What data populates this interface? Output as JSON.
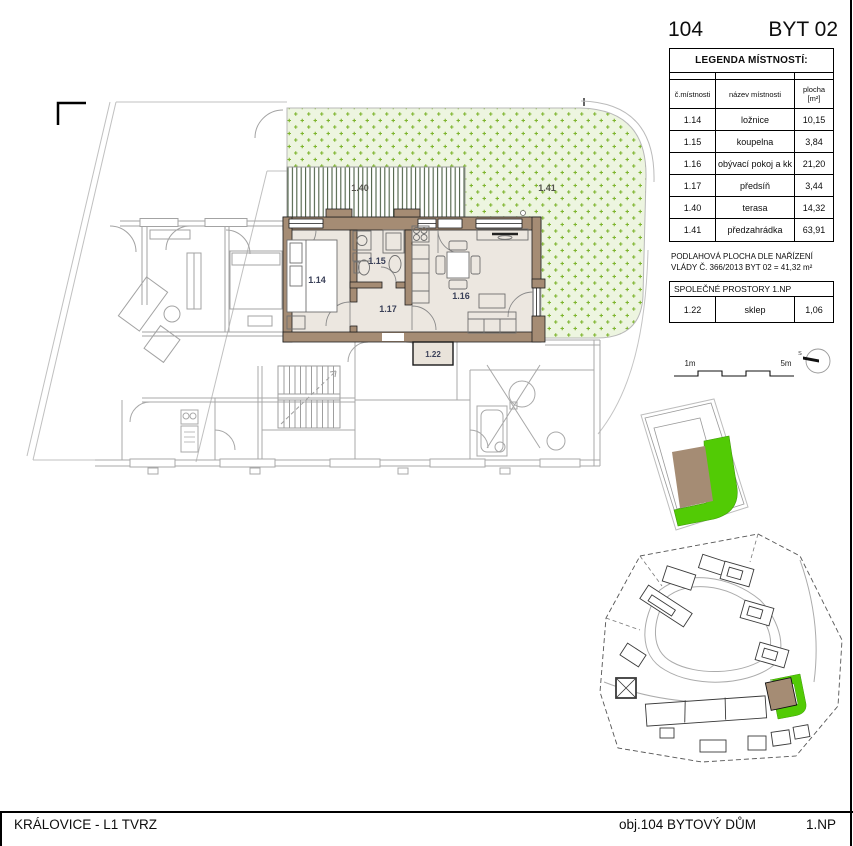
{
  "header": {
    "unit_number": "104",
    "unit_label": "BYT 02"
  },
  "legend": {
    "title": "LEGENDA MÍSTNOSTÍ:",
    "columns": {
      "c1": "č.místnosti",
      "c2": "název místnosti",
      "c3a": "plocha",
      "c3b": "[m²]"
    },
    "rows": [
      {
        "num": "1.14",
        "name": "ložnice",
        "area": "10,15"
      },
      {
        "num": "1.15",
        "name": "koupelna",
        "area": "3,84"
      },
      {
        "num": "1.16",
        "name": "obývací pokoj a kk",
        "area": "21,20"
      },
      {
        "num": "1.17",
        "name": "předsíň",
        "area": "3,44"
      },
      {
        "num": "1.40",
        "name": "terasa",
        "area": "14,32"
      },
      {
        "num": "1.41",
        "name": "předzahrádka",
        "area": "63,91"
      }
    ],
    "note_line1": "PODLAHOVÁ PLOCHA DLE NAŘÍZENÍ",
    "note_line2": "VLÁDY Č. 366/2013 BYT 02 = 41,32 m²",
    "common_title": "SPOLEČNÉ PROSTORY 1.NP",
    "common_row": {
      "num": "1.22",
      "name": "sklep",
      "area": "1,06"
    }
  },
  "plan": {
    "labels": {
      "bedroom": "1.14",
      "bathroom": "1.15",
      "living": "1.16",
      "hall": "1.17",
      "terrace": "1.40",
      "garden": "1.41",
      "cellar": "1.22"
    }
  },
  "scalebar": {
    "left_label": "1m",
    "right_label": "5m"
  },
  "compass": {
    "north_label": "S"
  },
  "footer": {
    "left": "KRÁLOVICE - L1 TVRZ",
    "project": "obj.104 BYTOVÝ DŮM",
    "floor": "1.NP"
  },
  "colors": {
    "wall_brown": "#a58c74",
    "floor_beige": "#ece7e0",
    "cellar_beige": "#e9e3da",
    "garden_bg": "#edf5e0",
    "garden_mark": "#7eb52f",
    "terrace_stripe": "#4e6147",
    "site_green": "#52cb05",
    "context_gray": "#b9b9b9"
  }
}
